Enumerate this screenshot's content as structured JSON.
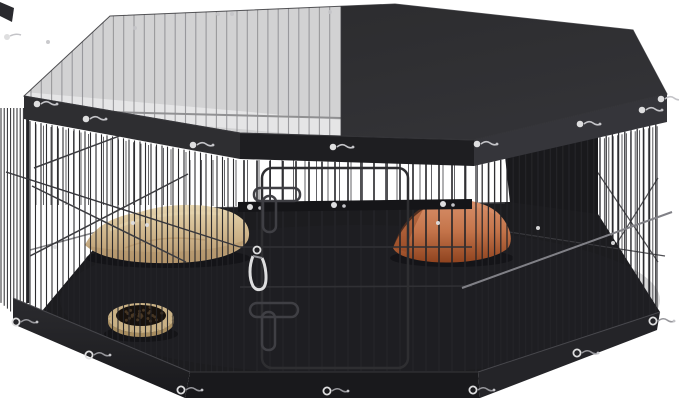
{
  "scene": {
    "type": "product-photo",
    "subject": "octagonal-pet-playpen-with-mesh-top",
    "background": "#ffffff",
    "objects": [
      "mesh-top-cover",
      "solid-top-cover-half",
      "cover-frame-band",
      "wire-panels",
      "door-with-slide-latches",
      "carabiner-clip",
      "tan-cushion",
      "orange-cushion",
      "food-bowl-with-kibble",
      "base-tray",
      "metal-eyelets",
      "metal-screw-clips"
    ],
    "colors": {
      "bg": "#ffffff",
      "coverSolidA": "#2a2a2c",
      "coverSolidB": "#343438",
      "mesh": "#d2d2d3",
      "meshLight": "#ededee",
      "meshStripe": "#8f8f92",
      "meshRail": "#88888a",
      "bandLeft": "#2e2e31",
      "bandMid": "#1e1e21",
      "bandRight": "#35353a",
      "edgeLight": "#48484d",
      "outline": "#2f2f33",
      "wireFront": "#242428",
      "wireDark": "#1e1e21",
      "wireBack": "#515155",
      "wireBackSoft": "#3f3f43",
      "wireBright": "#808086",
      "brace": "#3c3c40",
      "floor": "#1c1c1f",
      "floorDark": "#19191c",
      "floorSheen": "#2c2c31",
      "railDark": "#151518",
      "rail": "#2e2e32",
      "railSoft": "#303035",
      "baseFront": "#19191c",
      "baseLeft": "#2b2b2f",
      "baseRight": "#242428",
      "baseEdge": "#4a4a4f",
      "tan": "#d2b98f",
      "tanLight": "#e8d7b0",
      "tanDark": "#b3946a",
      "orange": "#c4744a",
      "orangeLight": "#d8906a",
      "orangeDark": "#8f431f",
      "bowl": "#c9b185",
      "bowlDark": "#a68c5f",
      "kibble": "#17110c",
      "kibbleDot": "#4a3a26",
      "metal": "#dededf",
      "metalSoft": "#c4c4c8",
      "metalDark": "#97979c",
      "shadow": "#0d0d10",
      "latch": "#3f3f44"
    }
  }
}
